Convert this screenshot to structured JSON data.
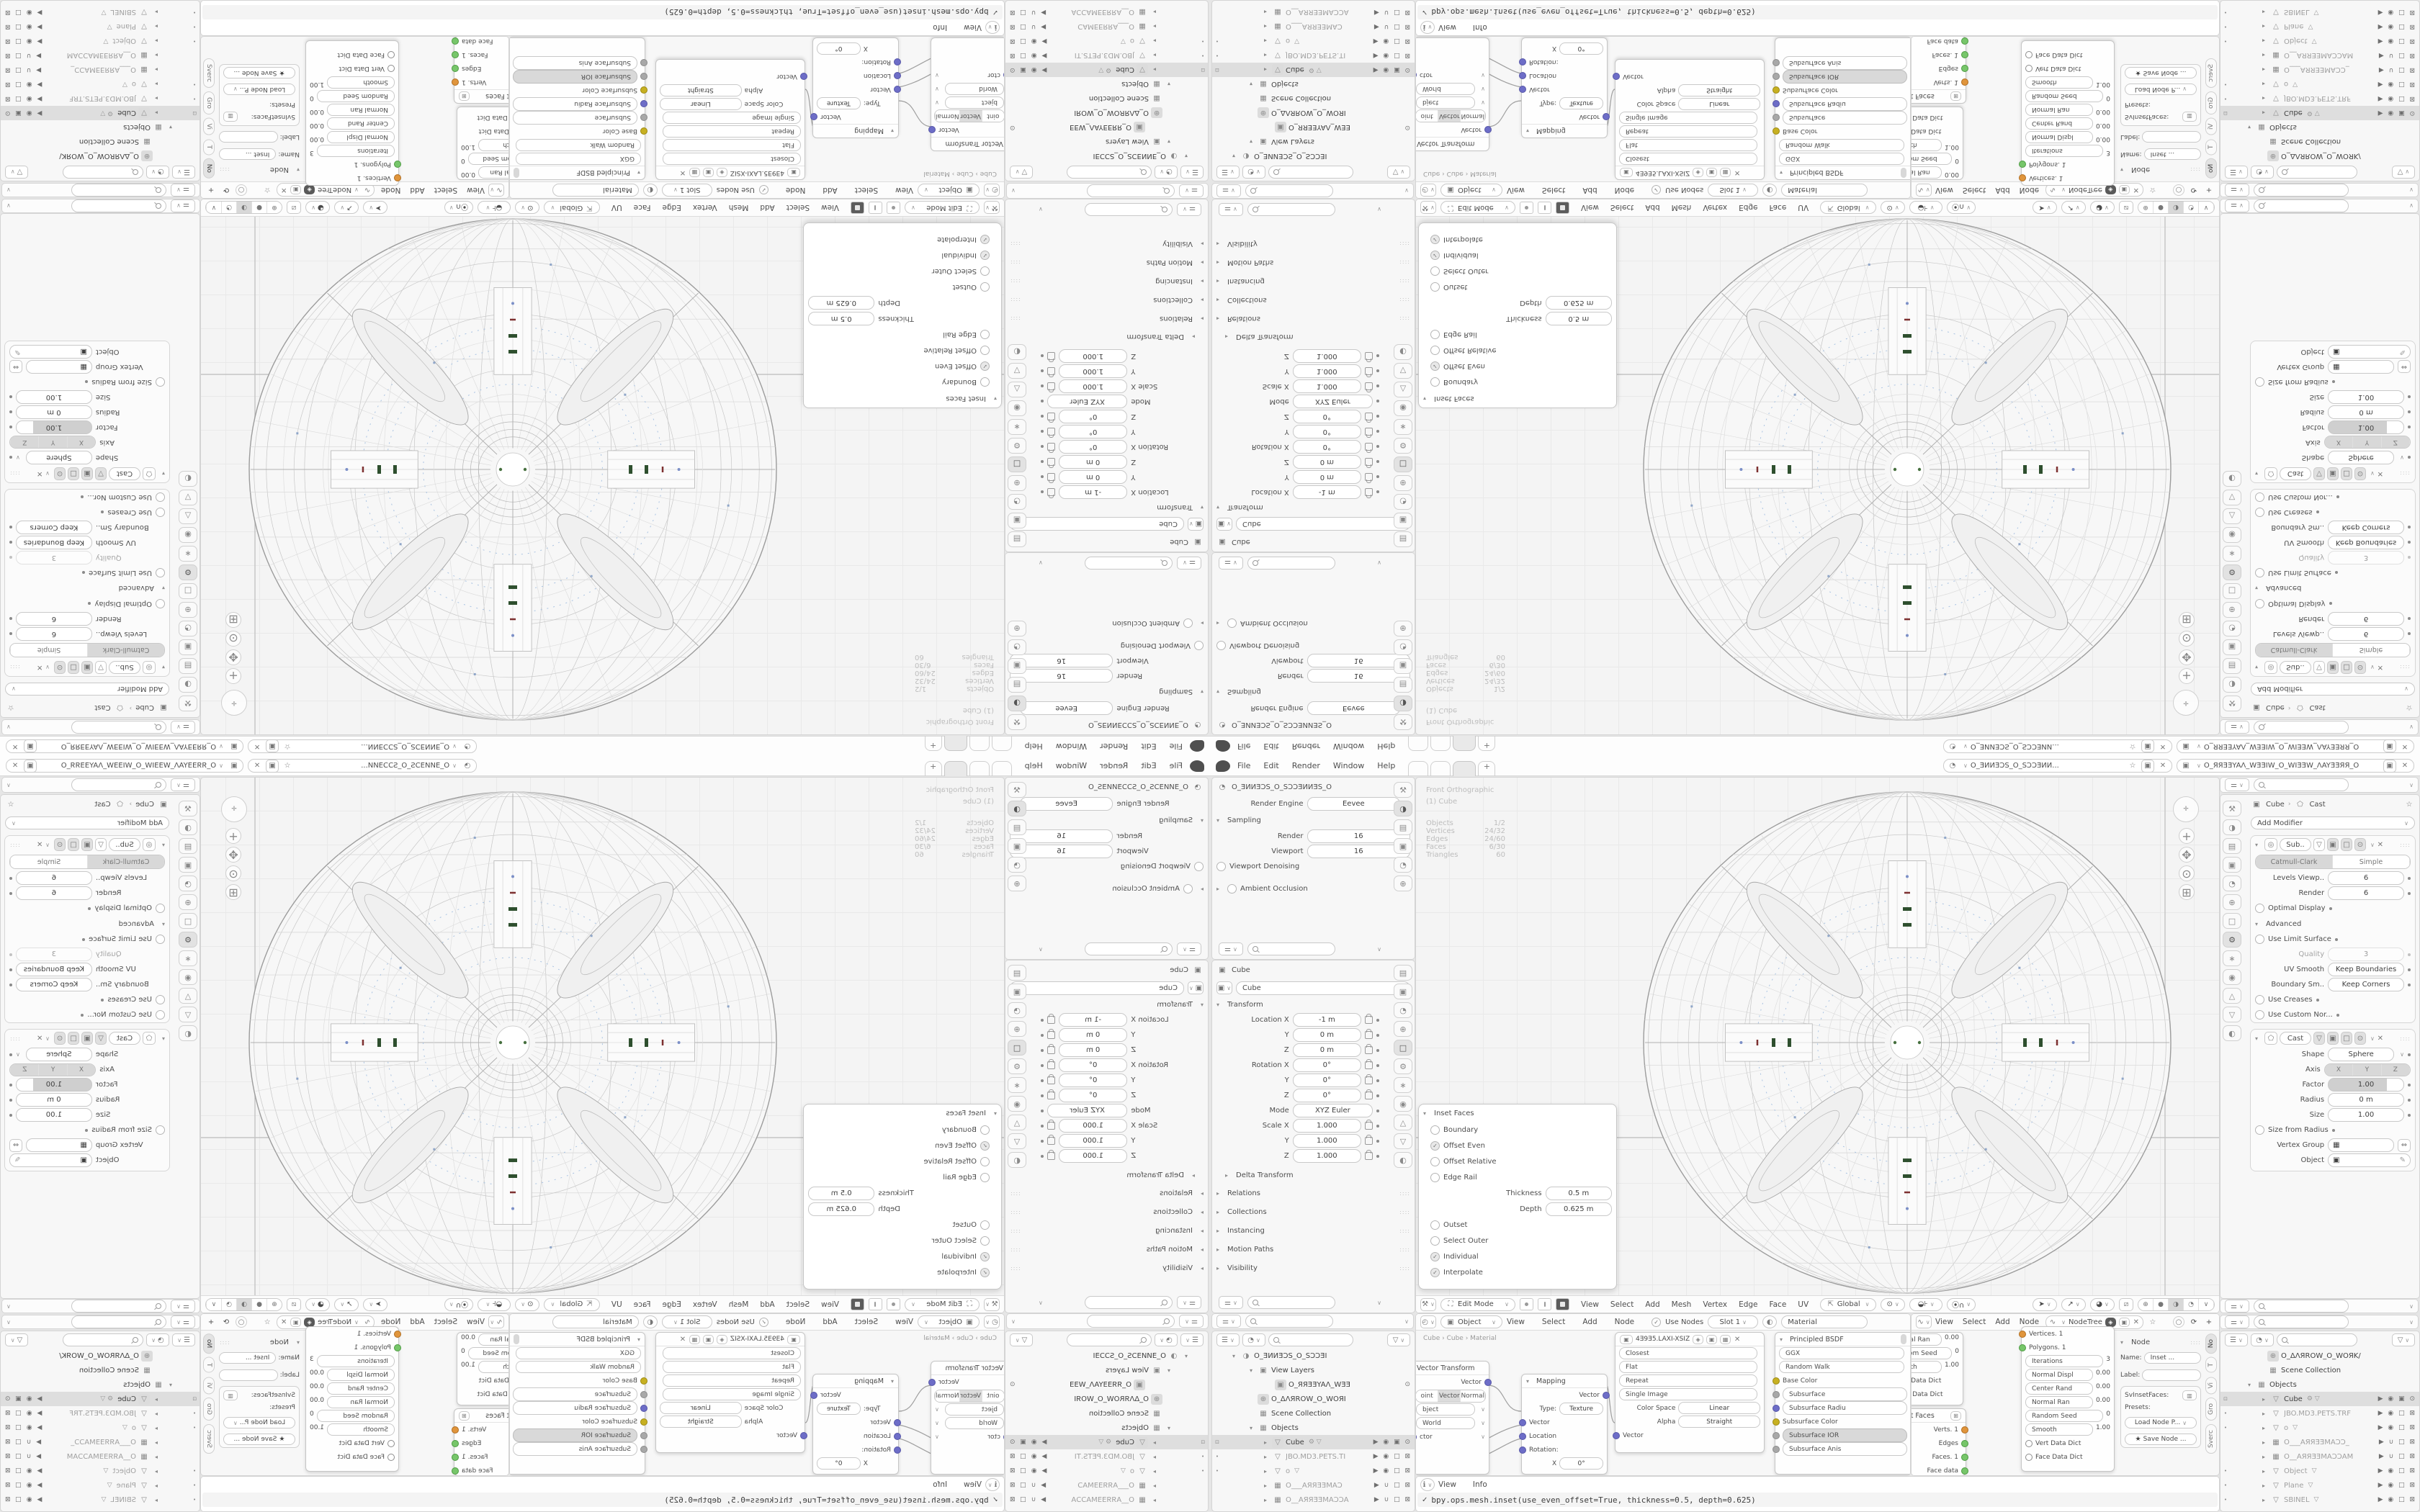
{
  "accent": {
    "area_bg": "#f7f7f7",
    "header_bg": "#fcfcfc",
    "highlight": "#dedede",
    "socket_blue": "#6d6dc7",
    "socket_yellow": "#c7b021",
    "socket_green": "#77c66a",
    "socket_orange": "#e0953c",
    "green_detail": "#2e4f2e",
    "red_detail": "#7d3030",
    "blue_detail": "#a9c3e2"
  },
  "app": {
    "logo_icon": "blender-logo",
    "menus": [
      "File",
      "Edit",
      "Render",
      "Window",
      "Help"
    ],
    "workspace_tabs": [
      "",
      "",
      ""
    ],
    "active_tab_index": 2,
    "new_tab_label": "+",
    "scene_name": "O_ƎИИƎƆЅ_O_ЅƆƆƎИИ...",
    "view_layer_name": "O_ЯЯƎƎYAΛ_WƎƎIW_O_WIƎƎW_ΛAYƎƎЯЯ_O"
  },
  "render_props": {
    "breadcrumb": "O_ƎИИƎƆЅ_O_ЅƆƆƎИИƎЅ_O",
    "engine_label": "Render Engine",
    "engine_value": "Eevee",
    "sampling_title": "Sampling",
    "rows": [
      {
        "c": "kv",
        "l": "Render",
        "v": "16"
      },
      {
        "c": "kv",
        "l": "Viewport",
        "v": "16"
      },
      {
        "c": "chk",
        "l": "Viewport Denoising"
      }
    ],
    "ao_title": "Ambient Occlusion"
  },
  "object_props": {
    "breadcrumb": "Cube",
    "name_value": "Cube",
    "transform_title": "Transform",
    "rows": [
      {
        "c": "kv lock",
        "l": "Location X",
        "v": "-1 m"
      },
      {
        "c": "kv lock",
        "l": "Y",
        "v": "0 m"
      },
      {
        "c": "kv lock",
        "l": "Z",
        "v": "0 m"
      },
      {
        "c": "kv lock",
        "l": "Rotation X",
        "v": "0°"
      },
      {
        "c": "kv lock",
        "l": "Y",
        "v": "0°"
      },
      {
        "c": "kv lock",
        "l": "Z",
        "v": "0°"
      },
      {
        "c": "kv dot1",
        "l": "Mode",
        "v": "XYZ Euler"
      },
      {
        "c": "kv lock",
        "l": "Scale X",
        "v": "1.000"
      },
      {
        "c": "kv lock",
        "l": "Y",
        "v": "1.000"
      },
      {
        "c": "kv lock",
        "l": "Z",
        "v": "1.000"
      }
    ],
    "delta_title": "Delta Transform",
    "sections": [
      {
        "l": "Relations"
      },
      {
        "l": "Collections"
      },
      {
        "l": "Instancing"
      },
      {
        "l": "Motion Paths"
      },
      {
        "l": "Visibility"
      }
    ]
  },
  "outliner_left": {
    "rows": [
      {
        "ind": 14,
        "ar": "▾",
        "ic": "◑",
        "label": "O_ƎИИƎƆЅ_O_ЅƆƆƎІ"
      },
      {
        "ind": 38,
        "ar": "▾",
        "ic": "▣",
        "label": "View Layers"
      },
      {
        "ind": 62,
        "ar": "",
        "ic": "▣",
        "icb": "boxed",
        "label": "O_ЯЯƎƎYAΛ_WƎƎ",
        "right": "⊙"
      },
      {
        "ind": 38,
        "ar": "",
        "ic": "⊕",
        "icb": "boxed",
        "label": "O_ΔΛЯROW_O_WOЯI"
      },
      {
        "ind": 38,
        "ar": "",
        "ic": "▦",
        "label": "Scene Collection"
      },
      {
        "ind": 38,
        "ar": "▾",
        "ic": "▦",
        "label": "Objects"
      },
      {
        "lm": "⊡",
        "ind": 58,
        "ar": "▸",
        "ic": "▽",
        "icb": "boxed",
        "label": "Cube",
        "cls": "hl",
        "badge": "⚙ ▽",
        "right": "▶ ◉ ▣ ⊙"
      },
      {
        "lm": "•",
        "ind": 58,
        "ar": "▸",
        "ic": "▽",
        "label": "JBO.MD3.PETS.TI",
        "cls": "dim",
        "right": "▶ ◉ □ ⊠"
      },
      {
        "lm": "•",
        "ind": 58,
        "ar": "▸",
        "ic": "▽",
        "label": "o",
        "cls": "dim",
        "badge": "▽",
        "right": "▶ ◉ □ ⊠"
      },
      {
        "ind": 58,
        "ar": "▸",
        "ic": "▦",
        "label": "O___AЯЯƎƎMAƆ",
        "cls": "dim",
        "right": "▶ ∪ □ ⊠"
      },
      {
        "ind": 58,
        "ar": "▸",
        "ic": "▦",
        "label": "O__AЯЯƎƎMAƆƆA",
        "cls": "dim",
        "right": "▶ ∪ □ ⊠"
      }
    ]
  },
  "viewport": {
    "view_label": "Front Orthographic",
    "object_label": "(1) Cube",
    "stats": [
      {
        "l": "Objects",
        "v": "1/2"
      },
      {
        "l": "Vertices",
        "v": "24/32"
      },
      {
        "l": "Edges",
        "v": "24/60"
      },
      {
        "l": "Faces",
        "v": "6/30"
      },
      {
        "l": "Triangles",
        "v": "60"
      }
    ],
    "header": {
      "mode": "Edit Mode",
      "menus": [
        "View",
        "Select",
        "Add",
        "Mesh",
        "Vertex",
        "Edge",
        "Face",
        "UV"
      ],
      "orientation": "Global"
    }
  },
  "inset_panel": {
    "title": "Inset Faces",
    "rows": [
      {
        "c": "chk",
        "l": "Boundary"
      },
      {
        "c": "chk on",
        "l": "Offset Even"
      },
      {
        "c": "chk",
        "l": "Offset Relative"
      },
      {
        "c": "chk",
        "l": "Edge Rail"
      },
      {
        "c": "kv",
        "l": "Thickness",
        "v": "0.5 m"
      },
      {
        "c": "kv",
        "l": "Depth",
        "v": "0.625 m"
      },
      {
        "c": "chk",
        "l": "Outset"
      },
      {
        "c": "chk",
        "l": "Select Outer"
      },
      {
        "c": "chk on",
        "l": "Individual"
      },
      {
        "c": "chk on",
        "l": "Interpolate"
      }
    ]
  },
  "shader": {
    "header": {
      "mode": "Object",
      "menus": [
        "View",
        "Select",
        "Add",
        "Node"
      ],
      "use_nodes": "Use Nodes",
      "slot": "Slot 1",
      "material": "Material"
    },
    "breadcrumb": [
      "Cube",
      "Cube",
      "Material"
    ],
    "vector_transform": {
      "title": "Vector Transform",
      "out_rows": [
        {
          "c": "out",
          "l": "Vector",
          "s": "blue"
        }
      ],
      "seg": [
        "oint",
        "Vector",
        "Normal"
      ],
      "seg_active": 1,
      "rows": [
        {
          "c": "pillrow",
          "l": "bject"
        },
        {
          "c": "pillrow",
          "l": "World"
        },
        {
          "c": "in",
          "l": "ctor",
          "s": "blue"
        }
      ]
    },
    "mapping": {
      "title": "Mapping",
      "rows": [
        {
          "c": "out",
          "l": "Vector",
          "s": "blue"
        },
        {
          "c": "kv",
          "l": "Type:",
          "v": "Texture"
        },
        {
          "c": "in",
          "l": "Vector",
          "s": "blue"
        },
        {
          "c": "in",
          "l": "Location",
          "s": "blue"
        },
        {
          "c": "in",
          "l": "Rotation:",
          "s": "blue"
        },
        {
          "c": "kv",
          "l": "X",
          "v": "0°"
        }
      ]
    },
    "image_texture": {
      "name": "4Ǝ9Ǝ5.LAXI-XSIZ",
      "rows": [
        {
          "c": "pillrow",
          "l": "Closest"
        },
        {
          "c": "pillrow",
          "l": "Flat"
        },
        {
          "c": "pillrow",
          "l": "Repeat"
        },
        {
          "c": "pillrow",
          "l": "Single Image"
        },
        {
          "c": "kv",
          "l": "Color Space",
          "v": "Linear"
        },
        {
          "c": "kv",
          "l": "Alpha",
          "v": "Straight"
        },
        {
          "c": "in",
          "l": "Vector",
          "s": "blue"
        }
      ]
    },
    "principled": {
      "title": "Principled BSDF",
      "rows": [
        {
          "c": "pillrow",
          "l": "GGX"
        },
        {
          "c": "pillrow",
          "l": "Random Walk"
        },
        {
          "c": "in",
          "l": "Base Color",
          "s": "yellow"
        },
        {
          "c": "in pill2",
          "l": "Subsurface",
          "s": "grey"
        },
        {
          "c": "in pill2",
          "l": "Subsurface Radiu",
          "s": "blue"
        },
        {
          "c": "in",
          "l": "Subsurface Color",
          "s": "yellow"
        },
        {
          "c": "in sel",
          "l": "Subsurface IOR",
          "s": "grey"
        },
        {
          "c": "in pill2",
          "l": "Subsurface Anis",
          "s": "grey"
        }
      ]
    }
  },
  "sverchok": {
    "header": {
      "menus": [
        "View",
        "Select",
        "Add",
        "Node"
      ],
      "tree": "NodeTree"
    },
    "node_a": {
      "rows": [
        {
          "c": "pillrow",
          "l": "Normal Ran",
          "v": "0.00"
        },
        {
          "c": "pillrow",
          "l": "Random Seed",
          "v": "0"
        },
        {
          "c": "pillrow",
          "l": "Smooth",
          "v": "1.00"
        },
        {
          "c": "dict",
          "l": "Vert Data Dict",
          "s": "white"
        },
        {
          "c": "dict",
          "l": "Face Data Dict",
          "s": "white"
        }
      ]
    },
    "inset_node": {
      "title": "Inset Faces",
      "rows": [
        {
          "c": "out",
          "l": "Verts. 1",
          "s": "orange"
        },
        {
          "c": "out",
          "l": "Edges",
          "s": "green"
        },
        {
          "c": "out",
          "l": "Faces. 1",
          "s": "green"
        },
        {
          "c": "out",
          "l": "Face data",
          "s": "green"
        }
      ]
    },
    "node_c": {
      "rows": [
        {
          "c": "in",
          "l": "Vertices. 1",
          "s": "orange"
        },
        {
          "c": "in",
          "l": "Polygons. 1",
          "s": "green"
        },
        {
          "c": "pillrow sockl",
          "l": "Iterations",
          "v": "3",
          "s": "green"
        },
        {
          "c": "pillrow sockl",
          "l": "Normal Displ",
          "v": "0.00",
          "s": "green"
        },
        {
          "c": "pillrow sockl",
          "l": "Center Rand",
          "v": "0.00",
          "s": "green"
        },
        {
          "c": "pillrow sockl",
          "l": "Normal Ran",
          "v": "0.00",
          "s": "green"
        },
        {
          "c": "pillrow sockl",
          "l": "Random Seed",
          "v": "0",
          "s": "green"
        },
        {
          "c": "pillrow sockl",
          "l": "Smooth",
          "v": "1.00",
          "s": "green"
        },
        {
          "c": "dict",
          "l": "Vert Data Dict",
          "s": "white"
        },
        {
          "c": "dict",
          "l": "Face Data Dict",
          "s": "white"
        }
      ]
    },
    "node_panel": {
      "title": "Node",
      "name_label": "Name:",
      "name_value": "Inset ...",
      "label_label": "Label:",
      "type_label": "SvInsetFaces:",
      "presets_label": "Presets:",
      "load_button": "Load Node P...",
      "save_button": "Save Node ..."
    },
    "tabs": [
      {
        "l": "No",
        "on": "on"
      },
      {
        "l": "T"
      },
      {
        "l": "Vi"
      },
      {
        "l": "Gro"
      },
      {
        "l": "Sverc"
      }
    ]
  },
  "info": {
    "menus": [
      "View",
      "Info"
    ],
    "check": "✓",
    "command": "bpy.ops.mesh.inset(use_even_offset=True, thickness=0.5, depth=0.625)"
  },
  "modifiers": {
    "breadcrumb_object": "Cube",
    "breadcrumb_modifier": "Cast",
    "add_button": "Add Modifier",
    "subdivision": {
      "name": "Sub..",
      "tabs": [
        {
          "l": "Catmull-Clark",
          "on": "on"
        },
        {
          "l": "Simple"
        }
      ],
      "rows": [
        {
          "c": "kv",
          "l": "Levels Viewp..",
          "v": "6"
        },
        {
          "c": "kv",
          "l": "Render",
          "v": "6"
        },
        {
          "c": "chk",
          "l": "Optimal Display"
        }
      ],
      "advanced_title": "Advanced",
      "adv_rows": [
        {
          "c": "chk",
          "l": "Use Limit Surface"
        },
        {
          "c": "kv dis",
          "l": "Quality",
          "v": "3"
        },
        {
          "c": "kv",
          "l": "UV Smooth",
          "v": "Keep Boundaries"
        },
        {
          "c": "kv",
          "l": "Boundary Sm..",
          "v": "Keep Corners"
        },
        {
          "c": "chk",
          "l": "Use Creases"
        },
        {
          "c": "chk",
          "l": "Use Custom Nor..."
        }
      ]
    },
    "cast": {
      "name": "Cast",
      "shape_row": {
        "l": "Shape",
        "v": "Sphere"
      },
      "axis_label": "Axis",
      "axis": [
        {
          "l": "X",
          "on": "on"
        },
        {
          "l": "Y",
          "on": "on"
        },
        {
          "l": "Z",
          "on": "on"
        }
      ],
      "rows": [
        {
          "c": "kv slider",
          "l": "Factor",
          "v": "1.00"
        },
        {
          "c": "kv",
          "l": "Radius",
          "v": "0 m"
        },
        {
          "c": "kv",
          "l": "Size",
          "v": "1.00"
        },
        {
          "c": "chk",
          "l": "Size from Radius"
        }
      ],
      "vgroup_label": "Vertex Group",
      "object_label": "Object"
    }
  },
  "outliner_right": {
    "rows": [
      {
        "ind": 40,
        "ar": "",
        "ic": "⊕",
        "icb": "boxed",
        "label": "O_ΔΛЯROW_O_WOЯK/"
      },
      {
        "ind": 40,
        "ar": "",
        "ic": "▦",
        "label": "Scene Collection"
      },
      {
        "ind": 24,
        "ar": "▾",
        "ic": "▦",
        "label": "Objects"
      },
      {
        "lm": "⊡",
        "ind": 44,
        "ar": "▸",
        "ic": "▽",
        "icb": "boxed",
        "label": "Cube",
        "cls": "hl",
        "badge": "⚙ ▽",
        "right": "▶ ◉ ▣ ⊙"
      },
      {
        "lm": "•",
        "ind": 44,
        "ar": "▸",
        "ic": "▽",
        "label": "JBO.MD3.PETS.TRF",
        "cls": "dim",
        "right": "▶ ◉ □ ⊠"
      },
      {
        "lm": "•",
        "ind": 44,
        "ar": "▸",
        "ic": "▽",
        "label": "o",
        "cls": "dim",
        "badge": "▽",
        "right": "▶ ◉ □ ⊠"
      },
      {
        "ind": 44,
        "ar": "▸",
        "ic": "▦",
        "label": "O___AЯЯƎƎMAƆƆ_",
        "cls": "dim",
        "right": "▶ ∪ □ ⊠"
      },
      {
        "ind": 44,
        "ar": "▸",
        "ic": "▦",
        "label": "O__AЯЯƎƎMAƆƆAM",
        "cls": "dim",
        "right": "▶ ∪ □ ⊠"
      },
      {
        "lm": "•",
        "ind": 44,
        "ar": "▸",
        "ic": "▽",
        "label": "Object",
        "cls": "dim",
        "badge": "▽",
        "right": "▶ ◉ □ ⊠"
      },
      {
        "lm": "•",
        "ind": 44,
        "ar": "▸",
        "ic": "▽",
        "label": "Plane",
        "cls": "dim",
        "badge": "▽",
        "right": "▶ ◉ □ ⊠"
      },
      {
        "lm": "•",
        "ind": 44,
        "ar": "▸",
        "ic": "▽",
        "label": "SBINEL",
        "cls": "dim",
        "badge": "▽",
        "right": "▶ ◉ □ ⊠"
      }
    ]
  },
  "icon_strips": {
    "left_a": [
      {
        "g": "⚒",
        "n": "tool-icon"
      },
      {
        "g": "◑",
        "n": "render-icon",
        "on": "on"
      },
      {
        "g": "▤",
        "n": "output-icon"
      },
      {
        "g": "▣",
        "n": "view-layer-icon"
      },
      {
        "g": "◔",
        "n": "scene-icon"
      },
      {
        "g": "⊕",
        "n": "world-icon"
      }
    ],
    "left_b": [
      {
        "g": "▤",
        "n": "output-icon"
      },
      {
        "g": "▣",
        "n": "view-layer-icon"
      },
      {
        "g": "◔",
        "n": "scene-icon"
      },
      {
        "g": "⊕",
        "n": "world-icon"
      },
      {
        "g": "□",
        "n": "object-icon",
        "on": "on"
      },
      {
        "g": "⚙",
        "n": "modifiers-icon"
      },
      {
        "g": "∗",
        "n": "particles-icon"
      },
      {
        "g": "◉",
        "n": "physics-icon"
      },
      {
        "g": "△",
        "n": "constraints-icon"
      },
      {
        "g": "▽",
        "n": "data-icon"
      },
      {
        "g": "◐",
        "n": "material-icon"
      }
    ],
    "right": [
      {
        "g": "⚒",
        "n": "tool-icon"
      },
      {
        "g": "◑",
        "n": "render-icon"
      },
      {
        "g": "▤",
        "n": "output-icon"
      },
      {
        "g": "▣",
        "n": "view-layer-icon"
      },
      {
        "g": "◔",
        "n": "scene-icon"
      },
      {
        "g": "⊕",
        "n": "world-icon"
      },
      {
        "g": "□",
        "n": "object-icon"
      },
      {
        "g": "⚙",
        "n": "modifiers-icon",
        "on": "on"
      },
      {
        "g": "∗",
        "n": "particles-icon"
      },
      {
        "g": "◉",
        "n": "physics-icon"
      },
      {
        "g": "△",
        "n": "constraints-icon"
      },
      {
        "g": "▽",
        "n": "data-icon"
      },
      {
        "g": "◐",
        "n": "material-icon"
      }
    ]
  }
}
